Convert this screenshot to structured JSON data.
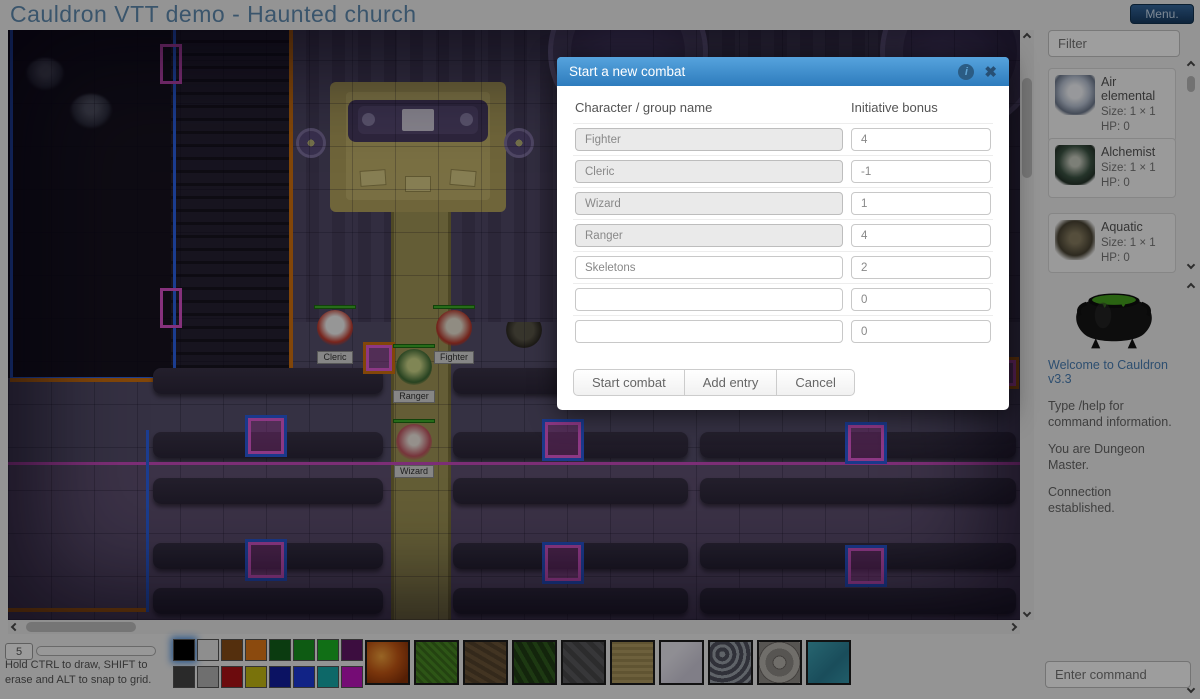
{
  "header": {
    "title": "Cauldron VTT demo - Haunted church",
    "menu_label": "Menu."
  },
  "modal": {
    "title": "Start a new combat",
    "name_header": "Character / group name",
    "bonus_header": "Initiative bonus",
    "rows": [
      {
        "name": "Fighter",
        "bonus": "4"
      },
      {
        "name": "Cleric",
        "bonus": "-1"
      },
      {
        "name": "Wizard",
        "bonus": "1"
      },
      {
        "name": "Ranger",
        "bonus": "4"
      },
      {
        "name": "Skeletons",
        "bonus": "2"
      },
      {
        "name": "",
        "bonus": "0"
      },
      {
        "name": "",
        "bonus": "0"
      }
    ],
    "buttons": {
      "start": "Start combat",
      "add": "Add entry",
      "cancel": "Cancel"
    }
  },
  "sidebar": {
    "filter_placeholder": "Filter",
    "tokens": [
      {
        "name": "Air elemental",
        "size": "Size: 1 × 1",
        "hp": "HP: 0"
      },
      {
        "name": "Alchemist",
        "size": "Size: 1 × 1",
        "hp": "HP: 0"
      },
      {
        "name": "Aquatic",
        "size": "Size: 1 × 1",
        "hp": "HP: 0"
      }
    ],
    "chat": {
      "welcome": "Welcome to Cauldron v3.3",
      "messages": [
        "Type /help for command information.",
        "You are Dungeon Master.",
        "Connection established."
      ]
    },
    "command_placeholder": "Enter command"
  },
  "bottombar": {
    "brush_size": "5",
    "hint": "Hold CTRL to draw, SHIFT to erase and ALT to snap to grid.",
    "palette": [
      [
        "#000000",
        "#e6e6e6",
        "#884d15",
        "#e07818",
        "#135f1a",
        "#179420",
        "#1cb424",
        "#611566"
      ],
      [
        "#454545",
        "#b3b3b3",
        "#ae1216",
        "#c3b813",
        "#121d9e",
        "#1c39d8",
        "#15a8a8",
        "#bd14bd"
      ]
    ],
    "textures": [
      "lava",
      "grass",
      "dirt",
      "foliage",
      "stone",
      "sand",
      "marble",
      "gravel",
      "cobblestone",
      "water"
    ]
  },
  "map": {
    "tokens": [
      {
        "label": "Cleric"
      },
      {
        "label": "Fighter"
      },
      {
        "label": "Ranger"
      },
      {
        "label": "Wizard"
      }
    ]
  }
}
